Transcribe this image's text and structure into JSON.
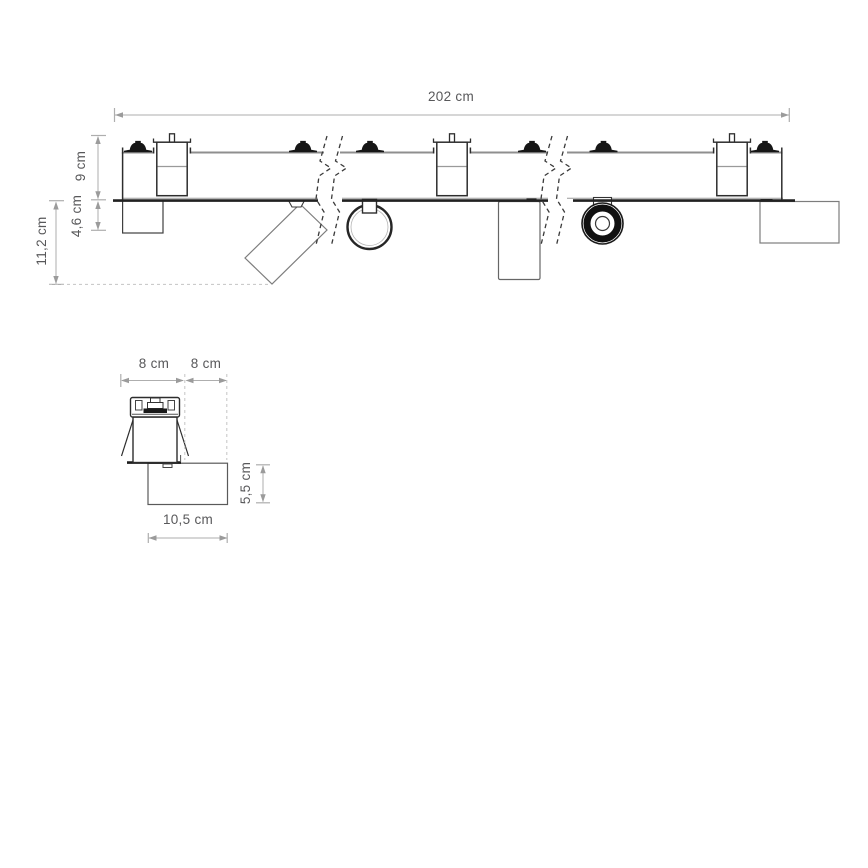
{
  "diagram": {
    "title": "track-lighting-dimension-drawing",
    "units": "cm",
    "colors": {
      "line_dark": "#2d2d2d",
      "ceiling_line": "#212121",
      "dimension_line": "#aeaeae",
      "dimension_text": "#58585a"
    },
    "main_view": {
      "labels": {
        "total_length": "202 cm",
        "track_height": "9 cm",
        "spot_depth": "4,6 cm",
        "max_depth": "11,2 cm"
      }
    },
    "detail_view": {
      "labels": {
        "track_width": "8 cm",
        "side_offset": "8 cm",
        "box_height": "5,5 cm",
        "box_width": "10,5 cm"
      }
    }
  }
}
